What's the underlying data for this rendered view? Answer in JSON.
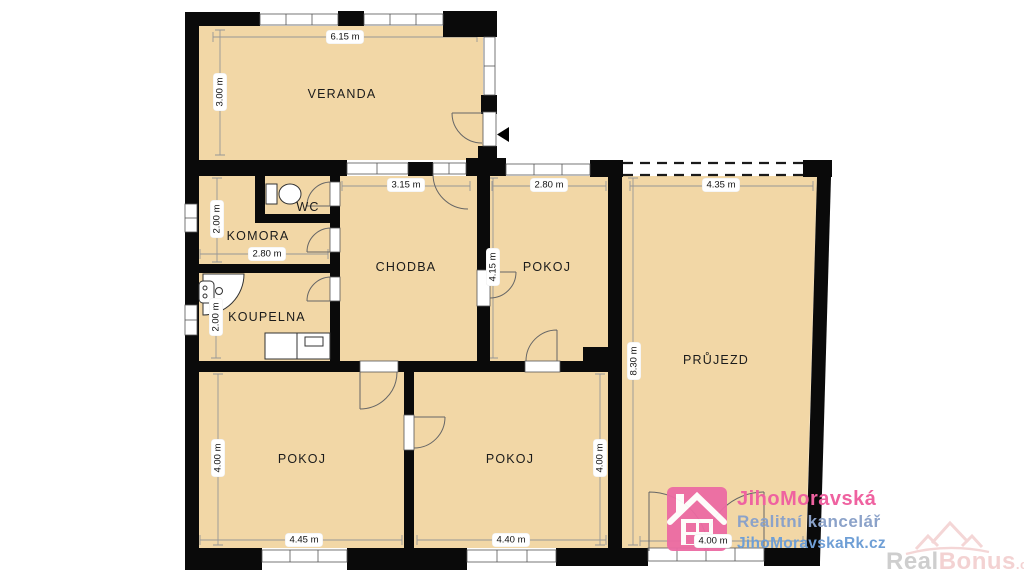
{
  "plan": {
    "rooms": [
      {
        "id": "veranda",
        "name": "VERANDA"
      },
      {
        "id": "wc",
        "name": "WC"
      },
      {
        "id": "komora",
        "name": "KOMORA"
      },
      {
        "id": "koupelna",
        "name": "KOUPELNA"
      },
      {
        "id": "chodba",
        "name": "CHODBA"
      },
      {
        "id": "pokoj-top",
        "name": "POKOJ"
      },
      {
        "id": "prujezd",
        "name": "PRŮJEZD"
      },
      {
        "id": "pokoj-bottom-left",
        "name": "POKOJ"
      },
      {
        "id": "pokoj-bottom-right",
        "name": "POKOJ"
      }
    ],
    "dimensions": [
      {
        "id": "veranda-width",
        "label": "6.15 m"
      },
      {
        "id": "veranda-height",
        "label": "3.00 m"
      },
      {
        "id": "chodba-width",
        "label": "3.15 m"
      },
      {
        "id": "pokoj-top-width",
        "label": "2.80 m"
      },
      {
        "id": "prujezd-width",
        "label": "4.35 m"
      },
      {
        "id": "komora-height",
        "label": "2.00 m"
      },
      {
        "id": "komora-width",
        "label": "2.80 m"
      },
      {
        "id": "koupelna-height",
        "label": "2.00 m"
      },
      {
        "id": "pokoj-top-height",
        "label": "4.15 m"
      },
      {
        "id": "prujezd-height",
        "label": "8.30 m"
      },
      {
        "id": "pokoj-bottom-left-height",
        "label": "4.00 m"
      },
      {
        "id": "pokoj-bottom-right-height",
        "label": "4.00 m"
      },
      {
        "id": "pokoj-bottom-left-width",
        "label": "4.45 m"
      },
      {
        "id": "pokoj-bottom-right-width",
        "label": "4.40 m"
      },
      {
        "id": "prujezd-door-width",
        "label": "4.00 m"
      }
    ]
  },
  "watermarks": {
    "agency": {
      "brand": "JihoMoravská",
      "tagline": "Realitní kancelář",
      "website": "JihoMoravskaRk.cz"
    },
    "portal": {
      "part1": "Real",
      "part2": "Bonus",
      "tld": ".cz"
    }
  },
  "colors": {
    "floor": "#f2d7a6",
    "wall": "#0a0a0a",
    "agency_pink": "#ef62a0",
    "agency_slate": "#8ba2c9",
    "agency_blue": "#6f9fd6",
    "portal_gray": "#c6c6c6",
    "portal_pink": "#f2cbcb"
  }
}
